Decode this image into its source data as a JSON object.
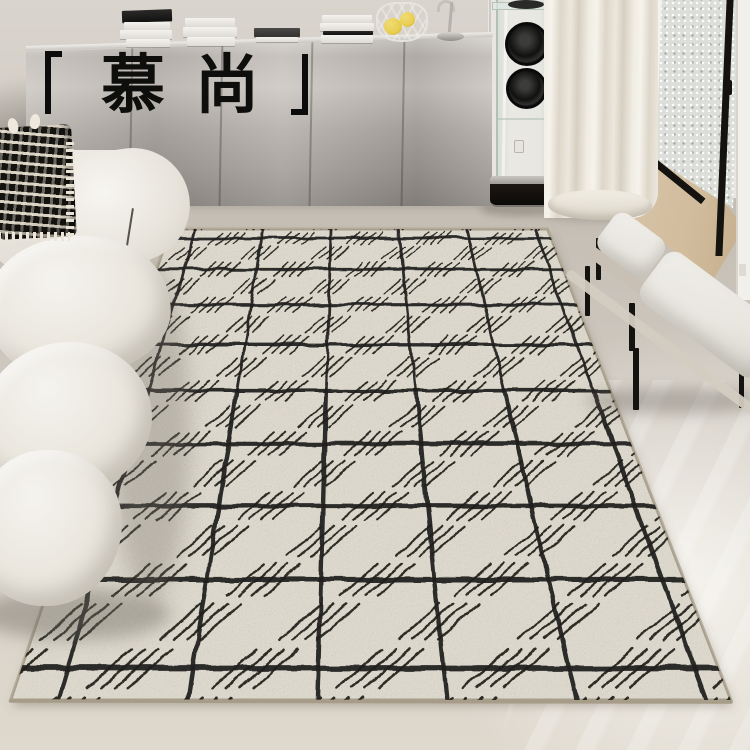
{
  "brand": {
    "char_left": "慕",
    "char_right": "尚",
    "bracket_left": "corner-bracket-open",
    "bracket_right": "corner-bracket-close"
  },
  "palette": {
    "wall": "#d9d4cd",
    "wallRight": "#e9e6e1",
    "steelLight": "#d8d4cf",
    "steelDark": "#8e8984",
    "curtain": "#ece7dd",
    "wood": "#d2bd9e",
    "glass": "#dcdeda",
    "black": "#141310",
    "lemon": "#e8ce52",
    "benchCushion": "#e9e6e0",
    "benchFrame": "#c8c0b4"
  },
  "scene": {
    "rug": "cream rug with black grid and hatched squares",
    "sofa": "white modular boucle sofa",
    "pillow": "black and white woven pillow with fringe",
    "sideboard": "stainless steel credenza with book stacks",
    "speaker": "glass tower speaker with two black drivers",
    "bench": "white cushioned bench with black metal legs",
    "curtain": "ivory floor-length curtain",
    "door": "black framed textured-glass door, open"
  },
  "rug": {
    "pattern": "grid-with-hatched-squares",
    "rows": 9,
    "cols": 6,
    "vp": [
      346,
      -289
    ],
    "x0": 195,
    "cell": 68,
    "row_recip_a": 0.0010449,
    "row_recip_step": 0.00010658,
    "t_min": -0.317,
    "t_max": 8.309,
    "u_min": -0.3676,
    "u_max": 5.191,
    "patch": {
      "half_u": 0.21,
      "half_t": 0.2,
      "stripes": 4
    },
    "field_color": "#ebe6da",
    "line_color": "#201f1b",
    "edge_color": "#b3aa97",
    "bottom_edge_color": "#a69c88",
    "shadow_color": "rgba(110,100,88,0.4)"
  }
}
